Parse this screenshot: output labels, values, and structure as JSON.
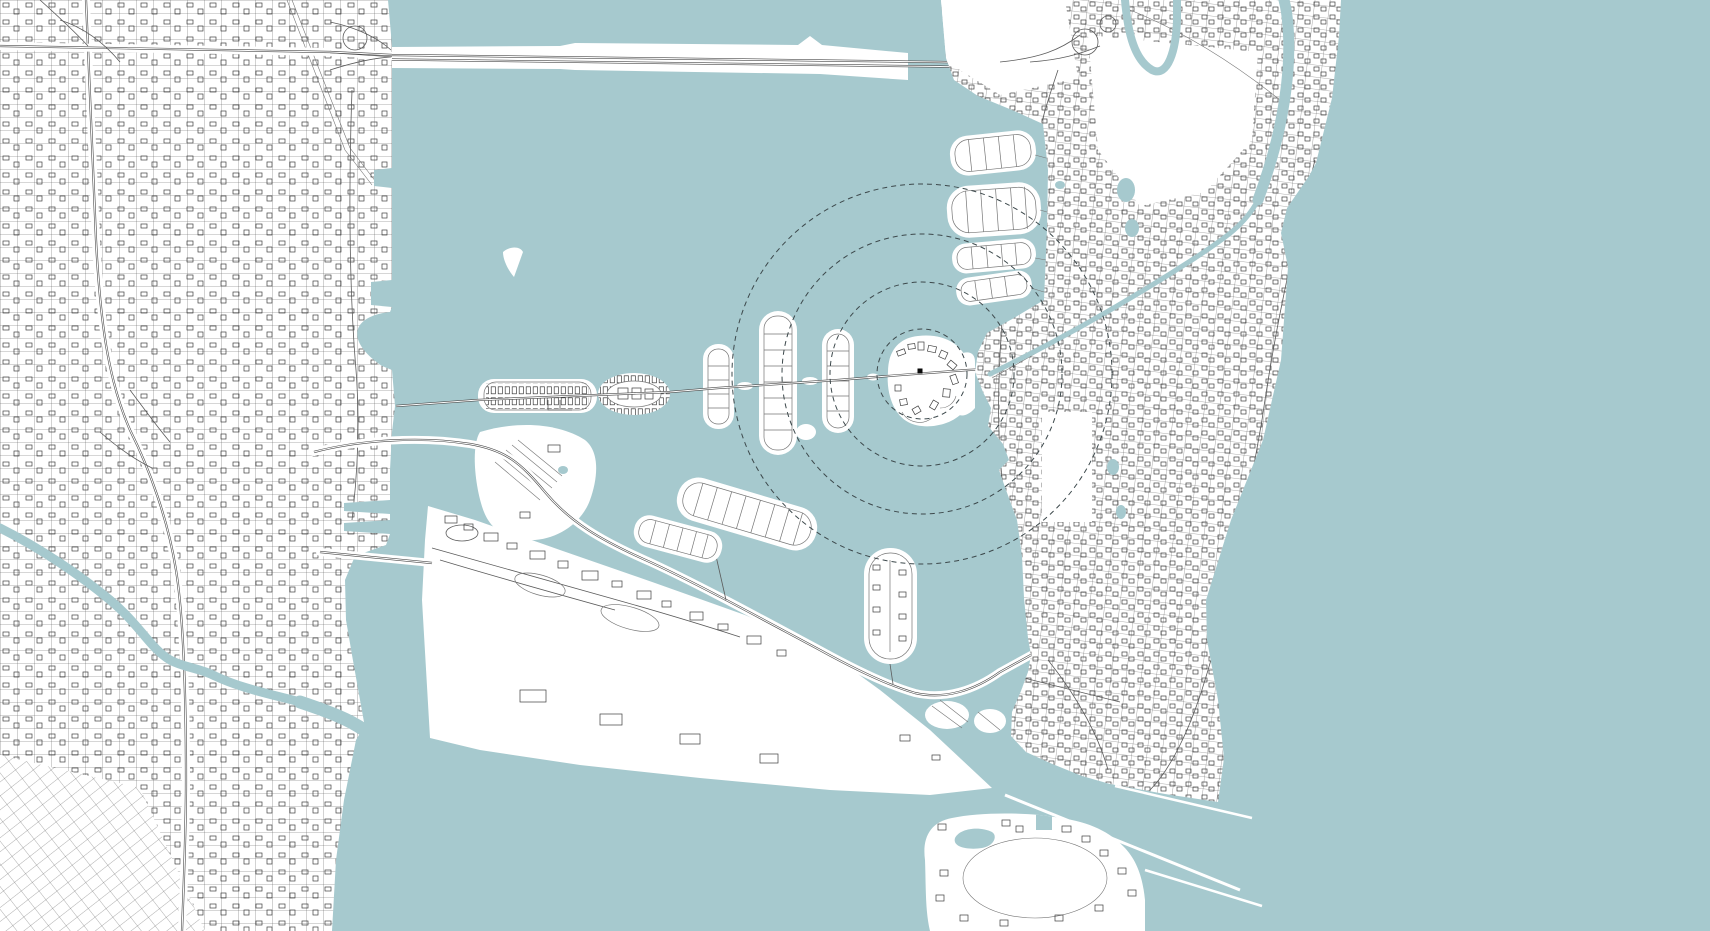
{
  "canvas": {
    "width": 1710,
    "height": 931
  },
  "map": {
    "style": "minimal-vector-city-map",
    "description": "coastal city with bay, barrier island, causeways, port island and ocean",
    "colors": {
      "water": "#a6c9ce",
      "land": "#ffffff",
      "street": "#5b5b5b",
      "street_major": "#4a4a4a",
      "building": "#3e3e3e",
      "detail": "#767676",
      "circle": "#3c484b",
      "marker": "#0a0a0a"
    },
    "overlay": {
      "marker": {
        "x": 920,
        "y": 371,
        "size": 5,
        "shape": "square"
      },
      "radius_circles": {
        "cx": 922,
        "cy": 374,
        "radii": [
          45,
          92,
          140,
          190
        ],
        "dash": "5 4"
      }
    },
    "features": [
      "mainland-city-grid",
      "diagonal-street-grid",
      "interstate-highway",
      "expressway-interchange",
      "river",
      "bay",
      "north-causeway",
      "island-chain-causeway",
      "marina-strip-island",
      "oval-marina-island",
      "residential-capsule-islands",
      "highlighted-island-with-marker",
      "south-causeway",
      "airport-park-island",
      "ladder-lot-islands",
      "star-shaped-island",
      "port-island",
      "cruise-terminals",
      "barrier-beach-city",
      "sunset-lot-islands",
      "beach-canal",
      "golf-course",
      "park-block",
      "inlet-channel",
      "jetties",
      "resort-island",
      "ocean"
    ]
  }
}
